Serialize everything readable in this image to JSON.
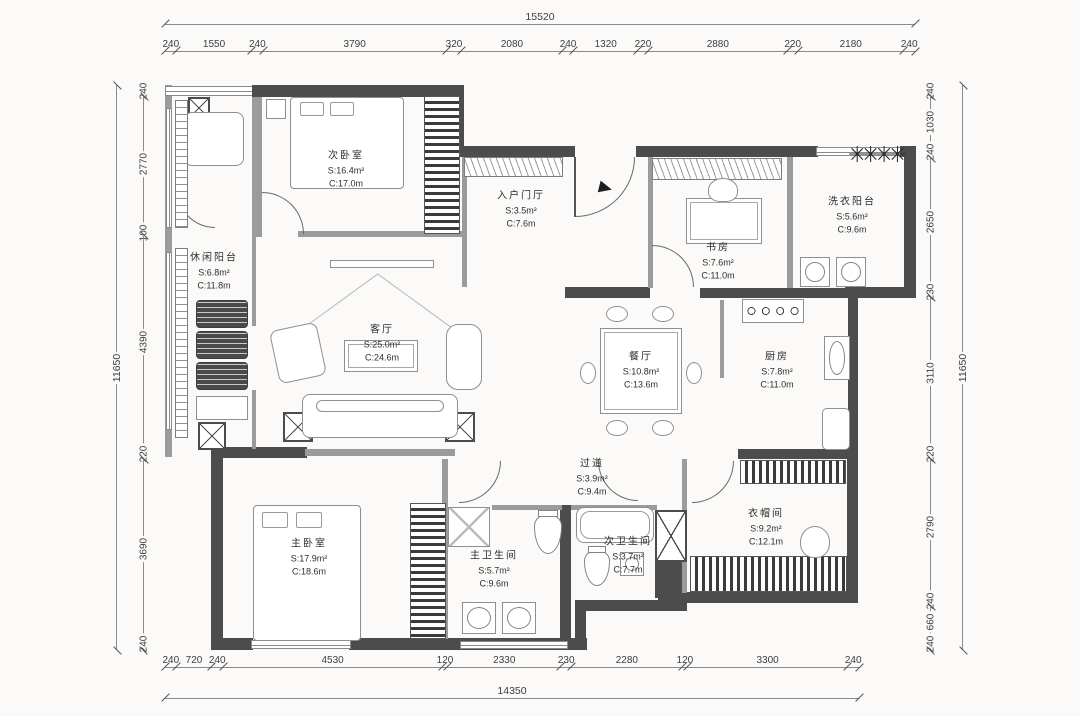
{
  "drawing": {
    "type": "apartment-floor-plan",
    "units": "mm"
  },
  "dims": {
    "top": {
      "total": "15520",
      "segments": [
        "240",
        "1550",
        "240",
        "3790",
        "320",
        "2080",
        "240",
        "1320",
        "220",
        "2880",
        "220",
        "2180",
        "240"
      ]
    },
    "bottom": {
      "total": "14350",
      "segments": [
        "240",
        "720",
        "240",
        "4530",
        "120",
        "2330",
        "230",
        "2280",
        "120",
        "3300",
        "240"
      ]
    },
    "left": {
      "total": "11650",
      "segments": [
        "240",
        "2770",
        "100",
        "4390",
        "220",
        "3690",
        "240"
      ]
    },
    "right": {
      "total": "11650",
      "segments": [
        "240",
        "1030",
        "240",
        "2650",
        "230",
        "3110",
        "220",
        "2790",
        "240",
        "660",
        "240"
      ]
    }
  },
  "rooms": [
    {
      "id": "second-bedroom",
      "name": "次卧室",
      "area": "S:16.4m²",
      "circumference": "C:17.0m"
    },
    {
      "id": "entry-foyer",
      "name": "入户门厅",
      "area": "S:3.5m²",
      "circumference": "C:7.6m"
    },
    {
      "id": "study",
      "name": "书房",
      "area": "S:7.6m²",
      "circumference": "C:11.0m"
    },
    {
      "id": "laundry-balcony",
      "name": "洗衣阳台",
      "area": "S:5.6m²",
      "circumference": "C:9.6m"
    },
    {
      "id": "leisure-balcony",
      "name": "休闲阳台",
      "area": "S:6.8m²",
      "circumference": "C:11.8m"
    },
    {
      "id": "living-room",
      "name": "客厅",
      "area": "S:25.0m²",
      "circumference": "C:24.6m"
    },
    {
      "id": "dining-room",
      "name": "餐厅",
      "area": "S:10.8m²",
      "circumference": "C:13.6m"
    },
    {
      "id": "kitchen",
      "name": "厨房",
      "area": "S:7.8m²",
      "circumference": "C:11.0m"
    },
    {
      "id": "corridor",
      "name": "过道",
      "area": "S:3.9m²",
      "circumference": "C:9.4m"
    },
    {
      "id": "master-bedroom",
      "name": "主卧室",
      "area": "S:17.9m²",
      "circumference": "C:18.6m"
    },
    {
      "id": "master-bathroom",
      "name": "主卫生间",
      "area": "S:5.7m²",
      "circumference": "C:9.6m"
    },
    {
      "id": "second-bathroom",
      "name": "次卫生间",
      "area": "S:3.7m²",
      "circumference": "C:7.7m"
    },
    {
      "id": "walk-in-closet",
      "name": "衣帽间",
      "area": "S:9.2m²",
      "circumference": "C:12.1m"
    }
  ]
}
